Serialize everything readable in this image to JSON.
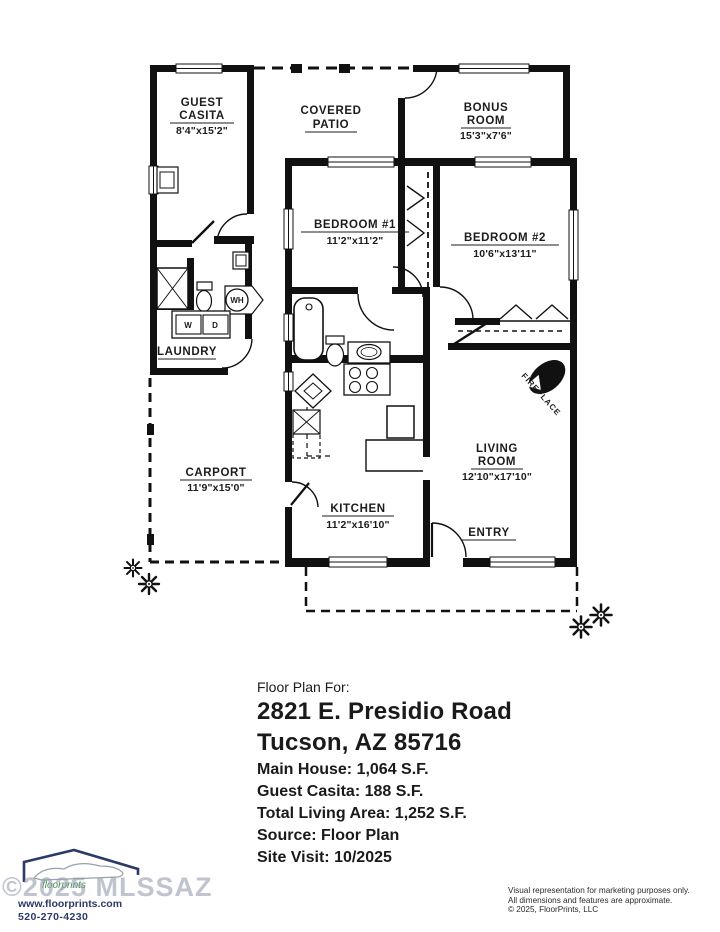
{
  "plan": {
    "rooms": [
      {
        "id": "guest-casita",
        "name": "GUEST",
        "name2": "CASITA",
        "dims": "8'4\"x15'2\""
      },
      {
        "id": "covered-patio",
        "name": "COVERED",
        "name2": "PATIO",
        "dims": ""
      },
      {
        "id": "bonus-room",
        "name": "BONUS",
        "name2": "ROOM",
        "dims": "15'3\"x7'6\""
      },
      {
        "id": "bedroom-1",
        "name": "BEDROOM #1",
        "dims": "11'2\"x11'2\""
      },
      {
        "id": "bedroom-2",
        "name": "BEDROOM #2",
        "dims": "10'6\"x13'11\""
      },
      {
        "id": "laundry",
        "name": "LAUNDRY",
        "dims": ""
      },
      {
        "id": "carport",
        "name": "CARPORT",
        "dims": "11'9\"x15'0\""
      },
      {
        "id": "kitchen",
        "name": "KITCHEN",
        "dims": "11'2\"x16'10\""
      },
      {
        "id": "living-room",
        "name": "LIVING",
        "name2": "ROOM",
        "dims": "12'10\"x17'10\""
      },
      {
        "id": "entry",
        "name": "ENTRY",
        "dims": ""
      }
    ],
    "labels": {
      "fireplace": "FIREPLACE",
      "water_heater": "WH",
      "washer": "W",
      "dryer": "D"
    }
  },
  "info": {
    "heading": "Floor Plan For:",
    "address_line1": "2821 E. Presidio Road",
    "address_line2": "Tucson, AZ  85716",
    "main_house": "Main House:  1,064 S.F.",
    "guest_casita": "Guest Casita:  188 S.F.",
    "total_living": "Total Living Area:  1,252 S.F.",
    "source": "Source:  Floor Plan",
    "site_visit": "Site Visit:  10/2025"
  },
  "footer": {
    "logo_text": "floorprints",
    "website": "www.floorprints.com",
    "phone": "520-270-4230",
    "watermark": "©2025 MLSSAZ",
    "disclaimer1": "Visual representation for marketing purposes only.",
    "disclaimer2": "All dimensions and features are approximate.",
    "copyright": "© 2025, FloorPrints, LLC"
  },
  "colors": {
    "wall": "#111111",
    "brand_navy": "#2b3a67",
    "brand_green": "#3e8e4a",
    "watermark_gray": "#969cad"
  }
}
